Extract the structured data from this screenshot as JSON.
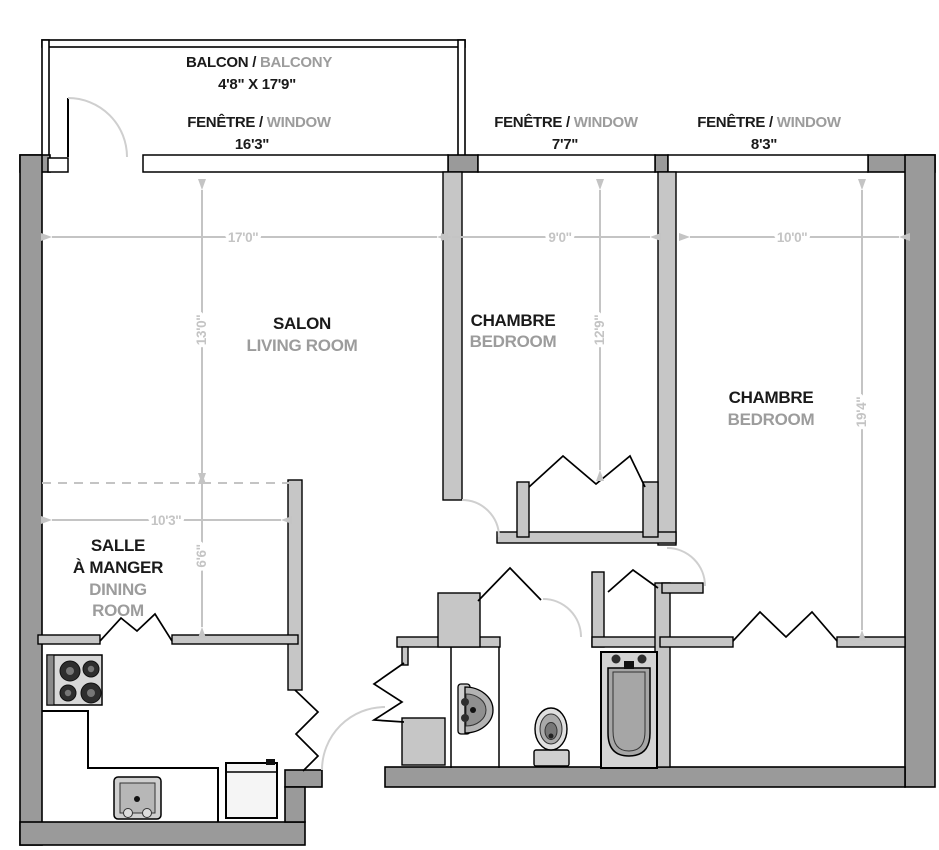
{
  "title": "Apartment floor plan",
  "sep": " / ",
  "colors": {
    "wall_outer": "#9a9a9a",
    "wall_inner": "#c6c6c6",
    "dim": "#c4c4c4",
    "door_arc": "#cfcfcf",
    "label_fr": "#1a1a1a",
    "label_en": "#9c9c9c"
  },
  "balcony": {
    "label_fr": "BALCON",
    "label_en": "BALCONY",
    "size": "4'8\" X 17'9\""
  },
  "windows": [
    {
      "label_fr": "FENÊTRE",
      "label_en": "WINDOW",
      "size": "16'3\""
    },
    {
      "label_fr": "FENÊTRE",
      "label_en": "WINDOW",
      "size": "7'7\""
    },
    {
      "label_fr": "FENÊTRE",
      "label_en": "WINDOW",
      "size": "8'3\""
    }
  ],
  "rooms": [
    {
      "id": "salon",
      "label_fr": "SALON",
      "label_en": "LIVING ROOM",
      "width": "17'0''",
      "depth": "13'0''"
    },
    {
      "id": "chambre-1",
      "label_fr": "CHAMBRE",
      "label_en": "BEDROOM",
      "width": "9'0''",
      "depth": "12'9''"
    },
    {
      "id": "chambre-2",
      "label_fr": "CHAMBRE",
      "label_en": "BEDROOM",
      "width": "10'0''",
      "depth": "19'4''"
    },
    {
      "id": "salle-a-manger",
      "label_fr_line1": "SALLE",
      "label_fr_line2": "À MANGER",
      "label_en_line1": "DINING",
      "label_en_line2": "ROOM",
      "width": "10'3''",
      "depth": "6'6''"
    }
  ],
  "fixtures": [
    "stove",
    "kitchen-sink",
    "fridge",
    "vanity-sink",
    "toilet",
    "bathtub"
  ]
}
